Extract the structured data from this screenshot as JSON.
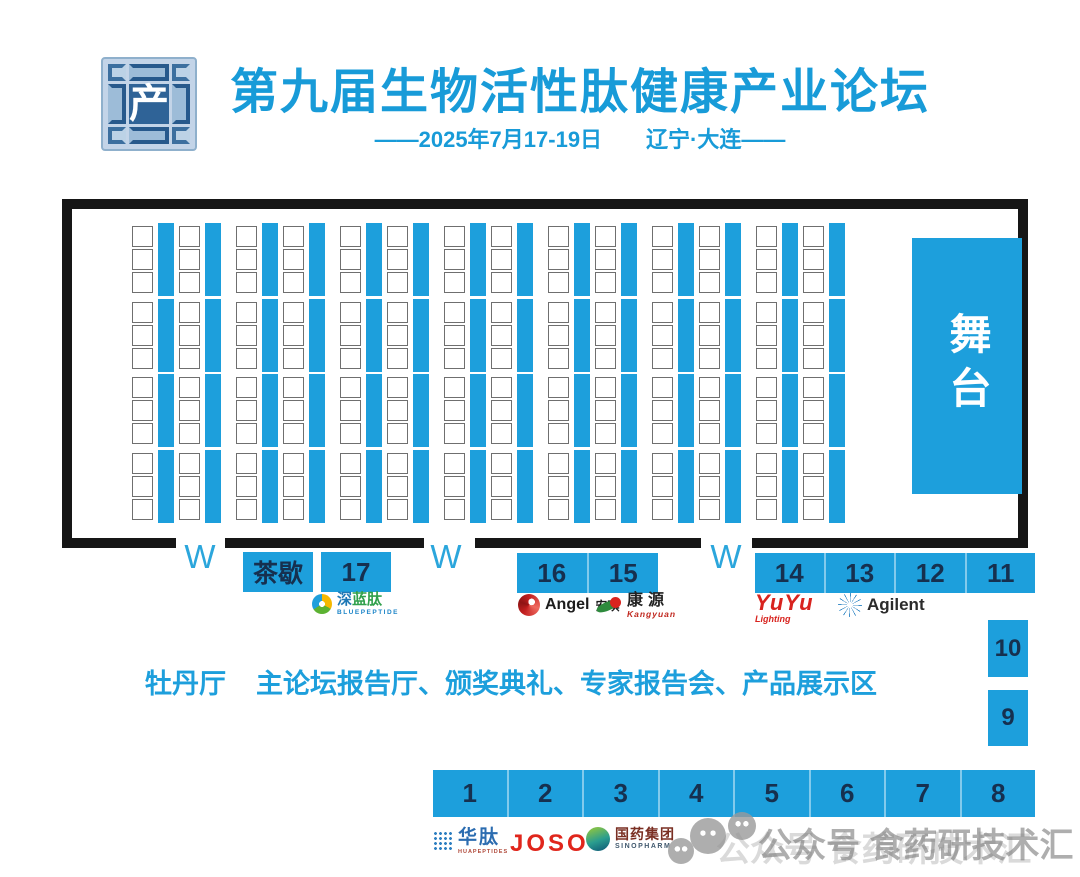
{
  "colors": {
    "accent": "#1d9fdc",
    "number": "#16304f",
    "border": "#161616",
    "door": "#2ba6dc",
    "seat_outline": "#6f6f6f",
    "watermark": "#9a9a9a",
    "title": "#189bd8"
  },
  "header": {
    "logo_char": "产",
    "title": "第九届生物活性肽健康产业论坛",
    "subtitle": "——2025年7月17-19日　　辽宁·大连——"
  },
  "hall": {
    "stage_label": "舞台",
    "doors": [
      "W",
      "W",
      "W"
    ],
    "seating": {
      "groups": 7,
      "seat_cols_per_group": 2,
      "strips_per_group": 2,
      "row_blocks": 4,
      "rows_per_block": 3
    }
  },
  "booths": {
    "tea_break_label": "茶歇",
    "booth_17": "17",
    "booths_16_15": [
      "16",
      "15"
    ],
    "booths_14_11": [
      "14",
      "13",
      "12",
      "11"
    ],
    "booth_10": "10",
    "booth_9": "9",
    "booths_1_8": [
      "1",
      "2",
      "3",
      "4",
      "5",
      "6",
      "7",
      "8"
    ]
  },
  "caption": {
    "hall_name": "牡丹厅",
    "description": "主论坛报告厅、颁奖典礼、专家报告会、产品展示区"
  },
  "sponsors": {
    "bluepeptide_cn": "深蓝肽",
    "bluepeptide_en": "BLUEPEPTIDE",
    "angel_en": "Angel",
    "angel_cn": "安琪",
    "kangyuan_cn": "康源",
    "kangyuan_en": "Kangyuan",
    "yuyu_line1": "YuYu",
    "yuyu_line2": "Lighting",
    "agilent": "Agilent",
    "huapeptides_cn": "华肽",
    "huapeptides_en": "HUAPEPTIDES",
    "joso": "JOSO",
    "sinopharm_cn": "国药集团",
    "sinopharm_en": "SINOPHARM"
  },
  "watermark": {
    "text": "公众号 食药研技术汇"
  }
}
